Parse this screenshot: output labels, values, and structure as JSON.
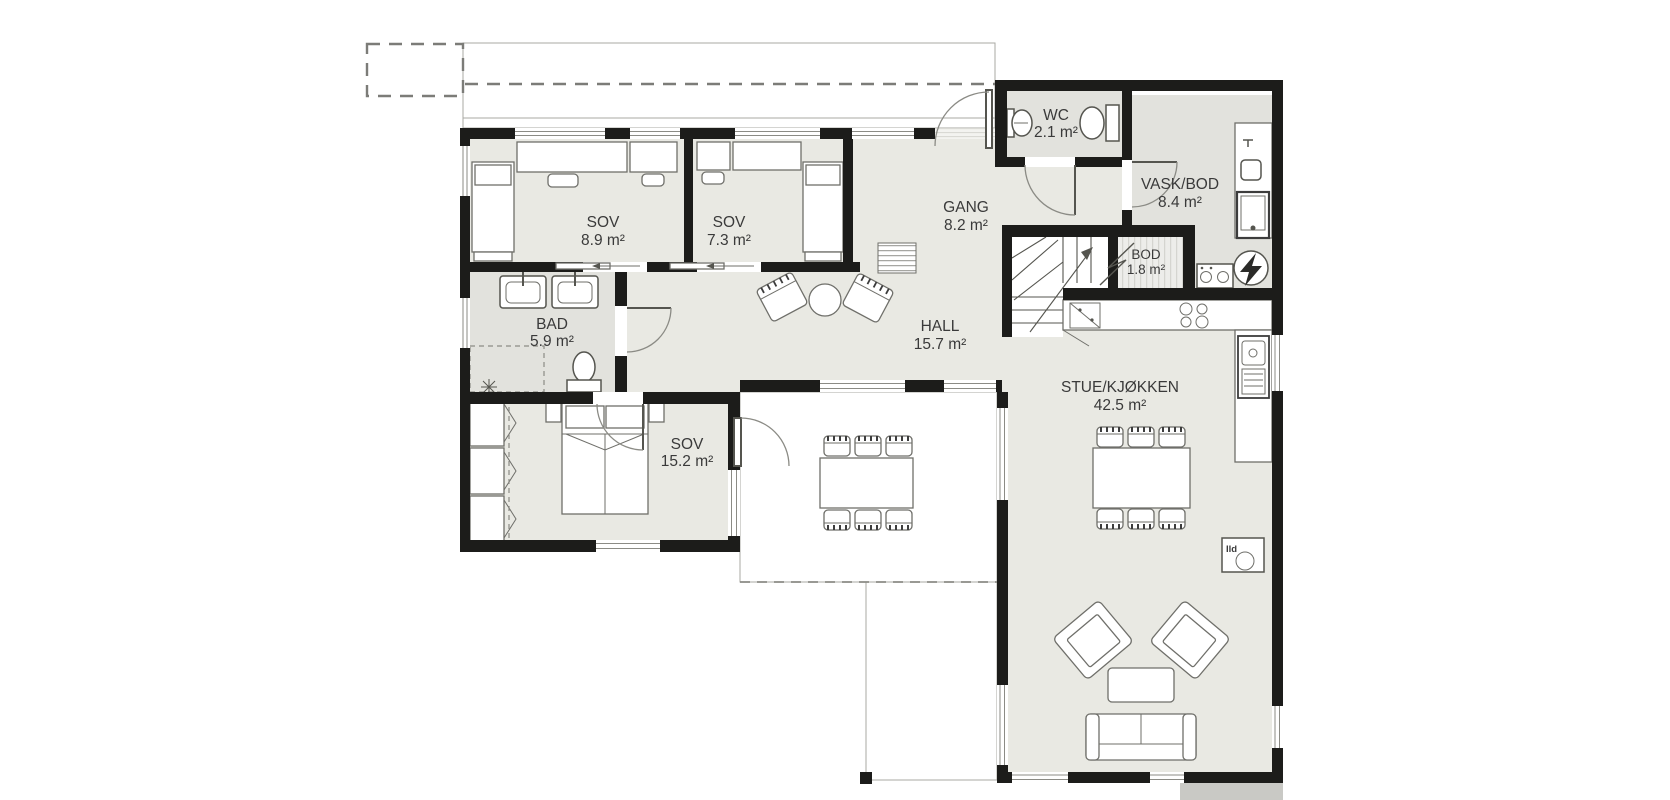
{
  "rooms": {
    "sov1": {
      "name": "SOV",
      "area": "8.9 m²"
    },
    "sov2": {
      "name": "SOV",
      "area": "7.3 m²"
    },
    "gang": {
      "name": "GANG",
      "area": "8.2 m²"
    },
    "wc": {
      "name": "WC",
      "area": "2.1 m²"
    },
    "vask": {
      "name": "VASK/BOD",
      "area": "8.4 m²"
    },
    "bod": {
      "name": "BOD",
      "area": "1.8 m²"
    },
    "bad": {
      "name": "BAD",
      "area": "5.9 m²"
    },
    "hall": {
      "name": "HALL",
      "area": "15.7 m²"
    },
    "sov3": {
      "name": "SOV",
      "area": "15.2 m²"
    },
    "stue": {
      "name": "STUE/KJØKKEN",
      "area": "42.5 m²"
    }
  },
  "annotations": {
    "fireplace_label": "Ild"
  },
  "colors": {
    "wall": "#1c1c1a",
    "room_fill": "#e9e9e3",
    "wet_room_fill": "#e2e2dd",
    "deck_fill": "#f6f6f3",
    "roof_hatch_fill": "#f3f3f0",
    "label_text": "#3a3a3a"
  }
}
